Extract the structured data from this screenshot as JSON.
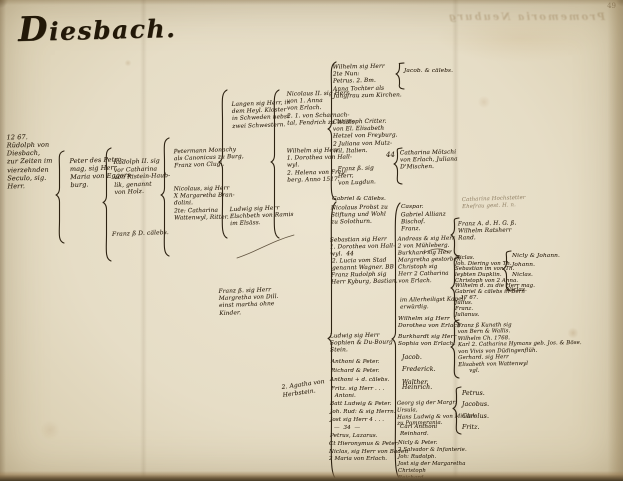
{
  "page": {
    "title": "Diesbach.",
    "page_number": "49",
    "bleedthrough_text": "Promemoria Neuburg"
  },
  "colors": {
    "ink": "#342818",
    "paper": "#e6ddc6",
    "edge_dark": "#463a25"
  },
  "tree": {
    "entries": [
      {
        "name": "entry-rudolph-von-diesbach",
        "x": 7,
        "y": 133,
        "w": 56,
        "fs": 6.5,
        "rot": -1,
        "lines": [
          "12 67.",
          "Rüdolph von",
          "Diesbach,",
          "zur Zeiten im",
          "vierzehnden",
          "Seculo, sig.",
          "Herr."
        ]
      },
      {
        "name": "entry-peter-petromag",
        "x": 70,
        "y": 156,
        "fs": 6.5,
        "rot": -2,
        "lines": [
          "Peter des Petro-",
          "mag, sig Herr",
          "Maria von Eggers-",
          "burg."
        ]
      },
      {
        "name": "entry-rudolph-ii",
        "x": 114,
        "y": 158,
        "fs": 6,
        "rot": -2,
        "lines": [
          "Rudolph II. sig",
          "vor Catharina",
          "von Ristein-Haub-",
          "lik, genannt",
          "von Holz."
        ]
      },
      {
        "name": "entry-franz-caelebs",
        "x": 112,
        "y": 230,
        "fs": 6,
        "rot": -2,
        "lines": [
          "Franz ß D. cälebs."
        ]
      },
      {
        "name": "entry-petermann-monachy",
        "x": 174,
        "y": 148,
        "fs": 5.8,
        "rot": -2,
        "lines": [
          "Petermann Monachy",
          "als Canonicus zu Burg,",
          "Franz von Clugi."
        ]
      },
      {
        "name": "entry-nicolaus-brandolini",
        "x": 174,
        "y": 186,
        "fs": 5.8,
        "rot": -1,
        "lines": [
          "Nicolaus, sig Herr",
          "X Margaretha Bran-",
          "dolini.",
          "2te: Catharina",
          "Wattenwyl, Ritter."
        ]
      },
      {
        "name": "entry-langen-kloster",
        "x": 232,
        "y": 101,
        "fs": 5.8,
        "rot": -2,
        "lines": [
          "Langen sig Herr, in",
          "dem Heyl. Kloster",
          "in Schweden nebst",
          "zwei Schwestern."
        ]
      },
      {
        "name": "entry-ludwig-ramis",
        "x": 230,
        "y": 206,
        "fs": 5.8,
        "rot": -2,
        "lines": [
          "Ludwig sig Herr",
          "Elschbeth von Ramis",
          "im Elsäss."
        ]
      },
      {
        "name": "entry-franz-dill",
        "x": 219,
        "y": 288,
        "fs": 5.8,
        "rot": -2,
        "lines": [
          "Franz ß. sig Herr",
          "Margretha von Dill.",
          "einst martha ohne",
          "Kinder."
        ]
      },
      {
        "name": "entry-nicolaus-ii",
        "x": 287,
        "y": 91,
        "fs": 5.8,
        "rot": -1,
        "lines": [
          "Nicolaus II. sig Herr",
          "von 1. Anna",
          "von Erlach.",
          "2. 1. von Scharnach-",
          "tal, Fendrich zu Wallis."
        ]
      },
      {
        "name": "entry-wilhelm-hallwyl",
        "x": 287,
        "y": 148,
        "fs": 5.8,
        "rot": -1,
        "lines": [
          "Wilhelm sig Herr",
          "1. Dorothea von Hall-",
          "wyl.",
          "2. Helena von Frey-",
          "berg. Anno 1517."
        ]
      },
      {
        "name": "entry-agatha-note",
        "x": 282,
        "y": 381,
        "fs": 6,
        "rot": -8,
        "lines": [
          "2. Agatha von",
          "Herbstein."
        ]
      },
      {
        "name": "entry-wilhelm-top",
        "x": 333,
        "y": 64,
        "fs": 5.8,
        "rot": -1,
        "lines": [
          "Wilhelm sig Herr",
          "2te Nun:",
          "Petrus. 2. Bm.",
          "Anna Tochter als",
          "Jungfrau zum Kirchen."
        ]
      },
      {
        "name": "entry-christoph-critter",
        "x": 333,
        "y": 119,
        "fs": 5.8,
        "rot": -1,
        "lines": [
          "Christoph Critter.",
          "von El. Elisabeth",
          "Hetzel von Freyburg.",
          "2 Juliana von Mutz-",
          "wil, Italien."
        ]
      },
      {
        "name": "entry-franz-lugdun",
        "x": 338,
        "y": 166,
        "fs": 5.8,
        "rot": -2,
        "lines": [
          "Franz ß. sig",
          "Herr,",
          "von Lugdun."
        ]
      },
      {
        "name": "entry-gabriel-caelebs",
        "x": 332,
        "y": 196,
        "fs": 5.8,
        "lines": [
          "Gabriel & Cälebs."
        ]
      },
      {
        "name": "entry-nicolaus-probst",
        "x": 331,
        "y": 205,
        "fs": 5.8,
        "rot": -1,
        "lines": [
          "Nicolaus Probst zu",
          "Stiftung und Wohl",
          "zu Solothurn."
        ]
      },
      {
        "name": "entry-sebastian",
        "x": 330,
        "y": 237,
        "fs": 5.8,
        "rot": -1,
        "lines": [
          "Sebastian sig Herr",
          "1. Dorothea von Hall-",
          "wyl.  44"
        ]
      },
      {
        "name": "entry-lucia-stad",
        "x": 332,
        "y": 258,
        "fs": 5.8,
        "rot": -1,
        "lines": [
          "2. Lucia vom Stad",
          "genannt Wagner. BB"
        ]
      },
      {
        "name": "entry-franz-rudolph",
        "x": 331,
        "y": 272,
        "fs": 5.8,
        "rot": -1,
        "lines": [
          "Franz Rudolph sig",
          "Herr Kyburg, Bastian."
        ]
      },
      {
        "name": "entry-ludwig-stein",
        "x": 330,
        "y": 333,
        "fs": 5.8,
        "rot": -1,
        "lines": [
          "Ludwig sig Herr",
          "Sophien & Du-Bourg",
          "Stein."
        ]
      },
      {
        "x": 331,
        "y": 359,
        "fs": 5.6,
        "lines": [
          "Anthoni & Peter."
        ]
      },
      {
        "x": 331,
        "y": 368,
        "fs": 5.6,
        "lines": [
          "Richard & Peter."
        ]
      },
      {
        "x": 330,
        "y": 377,
        "fs": 5.6,
        "lines": [
          "Anthoni + d. cälebs."
        ]
      },
      {
        "x": 331,
        "y": 386,
        "fs": 5.6,
        "lines": [
          "Fritz. sig Herr . . .",
          "  Antoni."
        ]
      },
      {
        "x": 330,
        "y": 401,
        "fs": 5.6,
        "lines": [
          "Batt Ludwig & Peter."
        ]
      },
      {
        "x": 330,
        "y": 409,
        "fs": 5.6,
        "lines": [
          "Joh. Rud: & sig Herrn."
        ]
      },
      {
        "x": 330,
        "y": 417,
        "fs": 5.6,
        "lines": [
          "Jost sig Herr 4 . . ."
        ]
      },
      {
        "x": 334,
        "y": 425,
        "fs": 5.6,
        "lines": [
          "—  34  —"
        ]
      },
      {
        "x": 330,
        "y": 433,
        "fs": 5.6,
        "lines": [
          "Petrus, Lazarus."
        ]
      },
      {
        "x": 329,
        "y": 441,
        "fs": 5.6,
        "lines": [
          "Ct Hieronymus & Peter."
        ]
      },
      {
        "x": 329,
        "y": 449,
        "fs": 5.6,
        "lines": [
          "Niclas, sig Herr von Baden",
          "2 Maria von Erlach."
        ]
      },
      {
        "name": "entry-jacob-caelebs",
        "x": 404,
        "y": 68,
        "fs": 5.8,
        "lines": [
          "Jacob. & cälebs."
        ]
      },
      {
        "name": "entry-catharina-moetschi",
        "x": 400,
        "y": 150,
        "fs": 5.8,
        "rot": -1,
        "lines": [
          "Catharina Mötschi",
          "von Erlach, Juliana",
          "D'Mischen."
        ]
      },
      {
        "name": "mark-44",
        "x": 386,
        "y": 151,
        "fs": 7,
        "lines": [
          "44"
        ]
      },
      {
        "x": 401,
        "y": 204,
        "fs": 5.8,
        "lines": [
          "Caspar."
        ]
      },
      {
        "name": "entry-gabriel-allianz",
        "x": 401,
        "y": 212,
        "fs": 5.8,
        "rot": -1,
        "lines": [
          "Gabriel Allianz",
          "Bischof.",
          "Franz."
        ]
      },
      {
        "name": "entry-andreas-group",
        "x": 398,
        "y": 236,
        "fs": 5.6,
        "rot": -1,
        "lines": [
          "Andreas & sig Herr",
          "2 von Mühleberg.",
          "Burkhard sig Herr",
          "Margretha gestorben.",
          "Christoph sig",
          "Herr 2 Catharina",
          "von Erlach."
        ]
      },
      {
        "name": "entry-kapell-note",
        "x": 400,
        "y": 297,
        "fs": 5.6,
        "rot": -1,
        "lines": [
          "im Allerheiligst Kapell",
          "erwürdig."
        ]
      },
      {
        "name": "entry-wilhelm-erlach",
        "x": 398,
        "y": 316,
        "fs": 5.8,
        "lines": [
          "Wilhelm sig Herr",
          "Dorothea von Erlach."
        ]
      },
      {
        "name": "entry-burkhardt-erlach",
        "x": 398,
        "y": 334,
        "fs": 5.8,
        "lines": [
          "Burkhardt sig Herr",
          "Sophia von Erlach."
        ]
      },
      {
        "x": 402,
        "y": 352,
        "fs": 6.2,
        "lh": 2.0,
        "lines": [
          "Jacob.",
          "Frederick.",
          "Walther."
        ]
      },
      {
        "x": 402,
        "y": 384,
        "fs": 6.2,
        "lines": [
          "Heinrich."
        ]
      },
      {
        "name": "entry-georg-pommern",
        "x": 397,
        "y": 400,
        "fs": 5.4,
        "rot": -1,
        "lines": [
          "Georg sig der Margr:",
          "Ursula,",
          "Hans Ludwig & von Mindel-",
          "zu Pommerania."
        ]
      },
      {
        "x": 400,
        "y": 424,
        "fs": 5.6,
        "lines": [
          "Carl Anthoni",
          "Reinhard."
        ]
      },
      {
        "x": 398,
        "y": 440,
        "fs": 5.4,
        "lines": [
          "Nicly & Peter."
        ]
      },
      {
        "x": 398,
        "y": 447,
        "fs": 5.4,
        "lines": [
          "2 Salvador & Infanterie."
        ]
      },
      {
        "x": 398,
        "y": 454,
        "fs": 5.4,
        "lines": [
          "Joh: Rudolph."
        ]
      },
      {
        "x": 398,
        "y": 461,
        "fs": 5.4,
        "lines": [
          "Jost sig der Margaretha",
          "Christoph",
          "Reichard."
        ]
      },
      {
        "name": "entry-hochstetter-note",
        "cls": "faint",
        "x": 462,
        "y": 196,
        "fs": 5.4,
        "rot": -2,
        "lines": [
          "Catharina Hochstetter",
          "Ehefrau gest. H. n."
        ]
      },
      {
        "name": "entry-franz-ratsherr",
        "x": 458,
        "y": 221,
        "fs": 5.8,
        "rot": -1,
        "lines": [
          "Franz A. d. H. G. ß.",
          "Wilhelm Ratsherr",
          "Rand."
        ]
      },
      {
        "name": "entry-niclas-group",
        "x": 455,
        "y": 256,
        "fs": 5.4,
        "lh": 1.05,
        "lines": [
          "Niclas.",
          "Joh. Diering von Th.",
          "Sebastian im von Th.",
          "leybten Dupklin.",
          "Christoph von 2 Anna.",
          "Wilhelm d. zu die Herr mag.",
          "Gabriel & cälebs in Bern",
          "   17 67.",
          "Julius.",
          "Franz.",
          "Julianus."
        ]
      },
      {
        "name": "entry-kunath-group",
        "x": 458,
        "y": 322,
        "fs": 5.4,
        "lh": 1.2,
        "rot": -1,
        "lines": [
          "Franz ß Kunath sig",
          "von Bern & Wallis.",
          "Wilhelm Ch. 1768.",
          "Karl 2. Catharina Hymans geb. Jos. & Böse.",
          "von Vivis von Düdingenflüh.",
          "Gerhard. sig Herr",
          "Elisabeth von Wattenwyl",
          "      vgl."
        ]
      },
      {
        "name": "entry-petrus-group",
        "x": 462,
        "y": 388,
        "fs": 6.2,
        "lh": 1.85,
        "lines": [
          "Petrus.",
          "Jacobus.",
          "Carolus.",
          "Fritz."
        ]
      },
      {
        "name": "entry-nicly-johann",
        "x": 512,
        "y": 252,
        "fs": 5.8,
        "lh": 1.6,
        "lines": [
          "Nicly & Johann.",
          "Johann.",
          "Niclas."
        ]
      },
      {
        "x": 506,
        "y": 287,
        "fs": 5.8,
        "lines": [
          "Niclas."
        ]
      }
    ],
    "braces": [
      {
        "x": 55,
        "y": 149,
        "h": 92
      },
      {
        "x": 102,
        "y": 146,
        "h": 113
      },
      {
        "x": 160,
        "y": 136,
        "h": 118
      },
      {
        "x": 218,
        "y": 88,
        "h": 148
      },
      {
        "x": 270,
        "y": 88,
        "h": 148
      },
      {
        "x": 327,
        "y": 60,
        "h": 138
      },
      {
        "x": 327,
        "y": 200,
        "h": 277
      },
      {
        "x": 395,
        "y": 61,
        "h": 26
      },
      {
        "x": 393,
        "y": 146,
        "h": 36
      },
      {
        "x": 391,
        "y": 201,
        "h": 276
      },
      {
        "x": 450,
        "y": 216,
        "h": 38
      },
      {
        "x": 450,
        "y": 255,
        "h": 66
      },
      {
        "x": 450,
        "y": 318,
        "h": 58
      },
      {
        "x": 452,
        "y": 385,
        "h": 47
      },
      {
        "x": 502,
        "y": 249,
        "h": 40
      }
    ],
    "curves": [
      {
        "d": "M237,258 C258,251 272,241 294,235"
      },
      {
        "d": "M424,253 C435,247 443,248 449,253"
      }
    ]
  }
}
